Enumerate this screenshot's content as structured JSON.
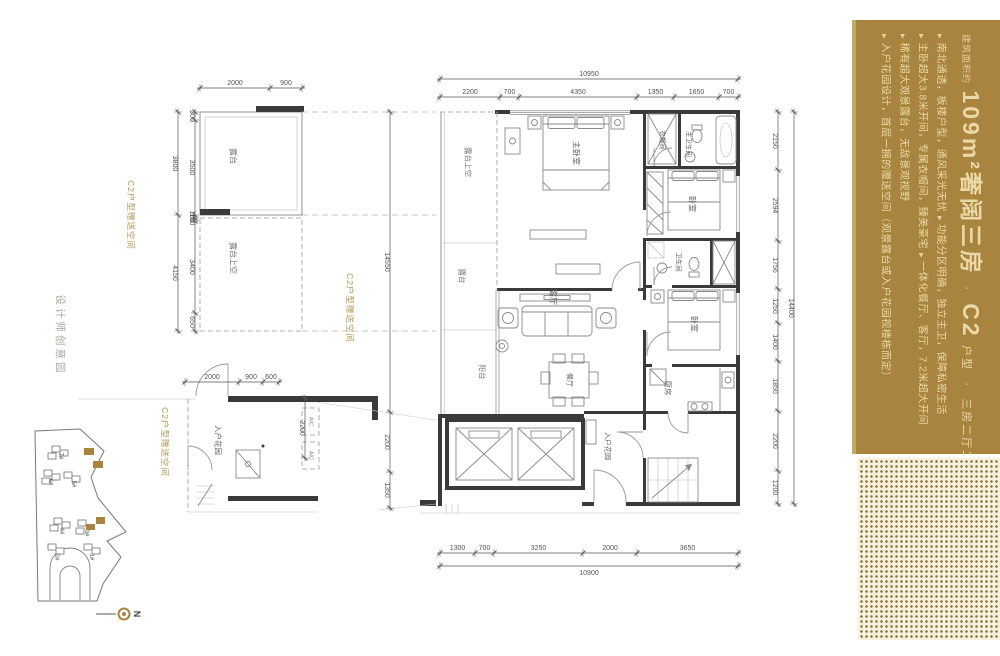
{
  "panel": {
    "eyebrow": "建筑面积约",
    "headline": "109m²奢阔三房",
    "sep1": "·",
    "unit_code": "C2",
    "unit_label": "户型",
    "sep2": "·",
    "spec": "三房二厅二卫",
    "marker": "▶",
    "bullets": [
      "南北通透，板楼户型，通风采光无忧",
      "功能分区明确，独立主卫，保障私密生活",
      "主卧超大3.8米开间，专属衣帽间，臻美豪宅",
      "一体化餐厅、客厅，7.2米超大开间",
      "稀有超大观景露台，无敌景观视野",
      "入户花园设计，首层一拥的赠送空间（观景露台或入户花园视楼栋而定）"
    ],
    "colors": {
      "background": "#a8843e",
      "text": "#ead9a6"
    }
  },
  "rooms": {
    "terrace": "露台",
    "terrace_void": "露台上空",
    "strip_void": "露台上空",
    "strip_terrace": "露台",
    "balcony": "阳台",
    "master_bedroom": "主卧室",
    "cloakroom": "衣帽间",
    "master_bath": "主卫生间",
    "bedroom2": "卧室",
    "bath2": "卫生间",
    "bedroom3": "卧室",
    "kitchen": "厨房",
    "living": "客厅",
    "dining": "餐厅",
    "entry_garden": "入户花园",
    "annex_entry_garden": "入户花园",
    "ac": "A/C"
  },
  "dims": {
    "top_left": [
      "2000",
      "900"
    ],
    "top": [
      "2200",
      "700",
      "4350",
      "1350",
      "1650",
      "700"
    ],
    "top_total": [
      "10950"
    ],
    "bottom": [
      "1300",
      "700",
      "3250",
      "2000",
      "3650"
    ],
    "bottom_total": [
      "10900"
    ],
    "right": [
      "2150",
      "2594",
      "1756",
      "1250",
      "1400",
      "1850",
      "2200",
      "1200"
    ],
    "right_total": [
      "14400"
    ],
    "left_inner": [
      "300",
      "3500",
      "100",
      "100",
      "3400",
      "650"
    ],
    "left_outer": [
      "3800",
      "4150"
    ],
    "left_long": [
      "14550",
      "2200",
      "1350"
    ],
    "annex_top": [
      "2000",
      "900",
      "600"
    ],
    "annex_right": [
      "2200"
    ]
  },
  "side_labels": {
    "designer": "设计师创意园",
    "gold1": "C2户型赠送空间",
    "gold2": "C2户型赠送空间",
    "gold3": "C2户型赠送空间"
  },
  "site_plan": {
    "buildings": [
      "1#",
      "2#",
      "3#",
      "4#",
      "5#",
      "6#",
      "7#"
    ],
    "north": "N"
  },
  "colors": {
    "gold": "#a8843e",
    "gold_label": "#b49a58",
    "wall": "#3a3a3a",
    "dim_line": "#555555",
    "gray_label": "#aba59b"
  }
}
